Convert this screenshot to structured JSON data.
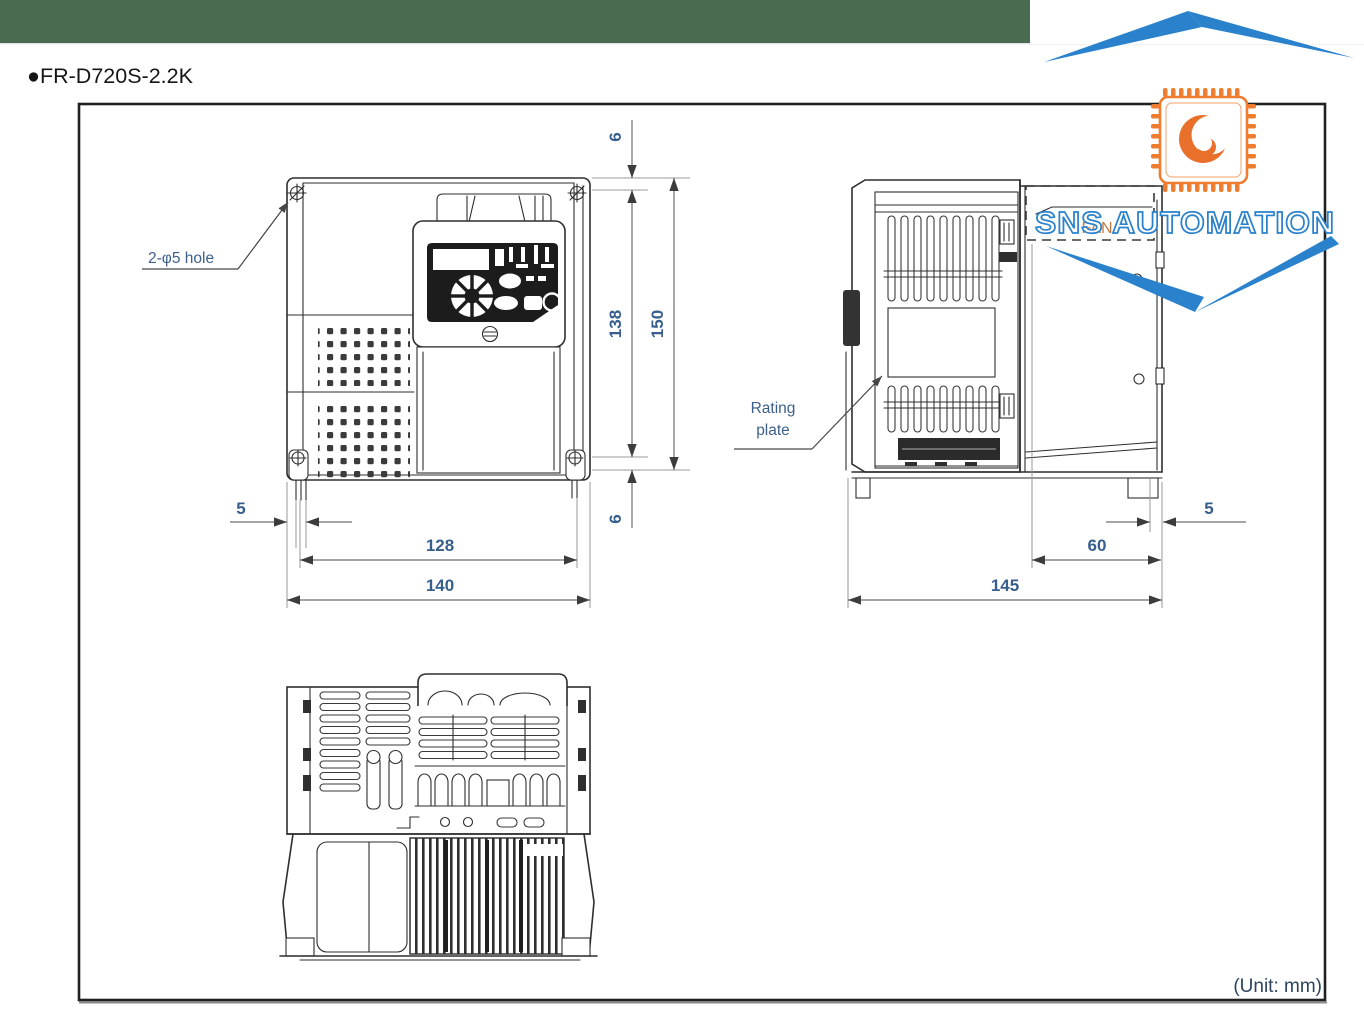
{
  "header": {
    "title": "●FR-D720S-2.2K"
  },
  "footer": {
    "unit_note": "(Unit: mm)"
  },
  "watermark": {
    "brand": "SNS AUTOMATION"
  },
  "colors": {
    "top_bar_green": "#4b6b51",
    "watermark_blue": "#2a82cc",
    "watermark_orange": "#ee7d2f",
    "dimension_text": "#375e8c",
    "fan_label_color": "#bf7b3f"
  },
  "front_view": {
    "hole_label": "2-φ5 hole",
    "dims": {
      "top_offset": "6",
      "hole_pitch_vertical": "138",
      "overall_height": "150",
      "bottom_offset": "6",
      "side_offset": "5",
      "hole_pitch_horizontal": "128",
      "overall_width": "140"
    }
  },
  "side_view": {
    "fan_label": "FAN",
    "rating_plate_line1": "Rating",
    "rating_plate_line2": "plate",
    "dims": {
      "fan_depth": "60",
      "edge_offset": "5",
      "overall_depth": "145"
    }
  },
  "bottom_view": {
    "name": "bottom-view"
  }
}
